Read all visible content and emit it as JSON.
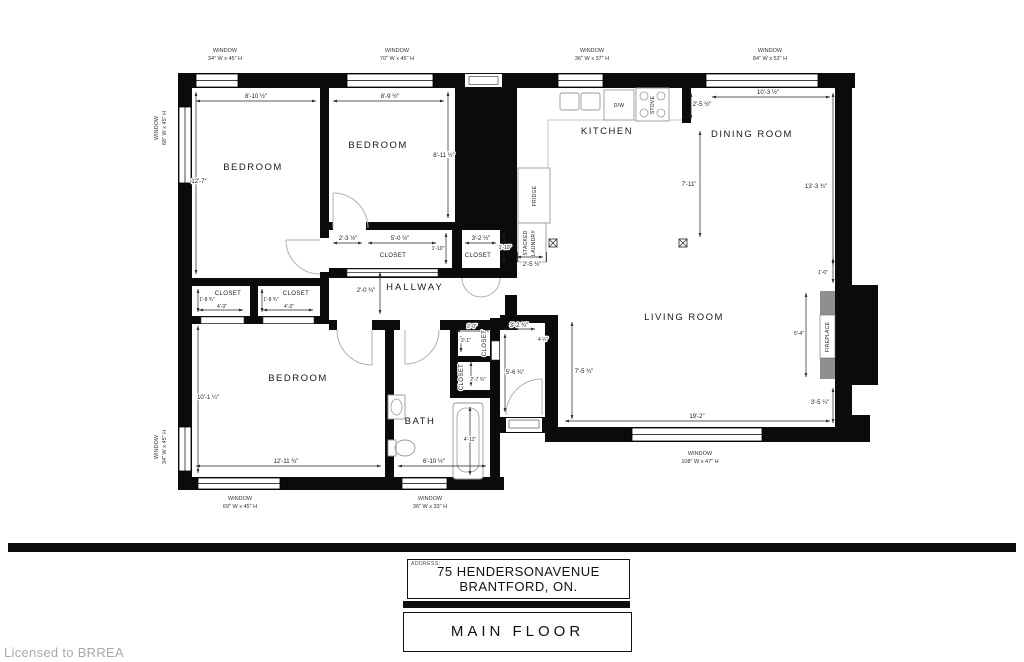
{
  "footer": {
    "address_label": "ADDRESS:",
    "address_line1": "75 HENDERSONAVENUE",
    "address_line2": "BRANTFORD, ON.",
    "floor_title": "MAIN FLOOR",
    "license": "Licensed to BRREA"
  },
  "rooms": {
    "bedroom1": "BEDROOM",
    "bedroom2": "BEDROOM",
    "bedroom3": "BEDROOM",
    "kitchen": "KITCHEN",
    "dining": "DINING ROOM",
    "living": "LIVING ROOM",
    "hallway": "HALLWAY",
    "bath": "BATH",
    "closet_mid": "CLOSET",
    "closet_right": "CLOSET",
    "closet_a": "CLOSET",
    "closet_b": "CLOSET",
    "closet_col_upper": "CLOSET",
    "closet_col_lower": "CLOSET"
  },
  "fixtures": {
    "dishwasher": "D/W",
    "stove": "STOVE",
    "fridge": "FRIDGE",
    "laundry1": "STACKED",
    "laundry2": "LAUNDRY",
    "fireplace": "FIREPLACE"
  },
  "windows": {
    "label": "WINDOW",
    "top1": "34\" W x 45\" H",
    "top2": "70\" W x 45\" H",
    "top3": "36\" W x 37\" H",
    "top4": "84\" W x 53\" H",
    "left1": "68\" W x 45\" H",
    "left2": "34\" W x 45\" H",
    "bottom1": "69\" W x 45\" H",
    "bottom2": "36\" W x 33\" H",
    "bottom3": "108\" W x 47\" H"
  },
  "dims": {
    "bed1_w": "8'-10 ½\"",
    "bed1_h": "12'-7\"",
    "bed2_w": "8'-9 ½\"",
    "bed2_h": "8'-11 ½\"",
    "bed2_door": "2'-3 ½\"",
    "closet_mid_w": "5'-0 ½\"",
    "closet_mid_d": "1'-10\"",
    "closet_r_w": "3'-2 ½\"",
    "closet_r_d": "1'-10\"",
    "kitchen_pass": "2'-5 ¾\"",
    "hall_w": "2'-0 ¾\"",
    "closet_a_d": "1'-8 ¾\"",
    "closet_a_w": "4'-3\"",
    "closet_b_d": "1'-8 ¾\"",
    "closet_b_w": "4'-3\"",
    "bed3_h": "10'-1 ¼\"",
    "bed3_w": "12'-11 ¾\"",
    "bath_tub": "4'-11\"",
    "bath_w": "6'-10 ½\"",
    "cc_w": "2'-0\"",
    "cc_h": "2'-1\"",
    "cc_d": "2'-7 ¾\"",
    "vest_w": "3'-2 ¾\"",
    "vest_jog": "4 ¼\"",
    "vest_h": "5'-6 ¾\"",
    "lr_h": "7'-5 ¾\"",
    "lr_w": "19'-2\"",
    "lr_corner": "3'-5 ¼\"",
    "fp_h": "5'-4\"",
    "fp_off": "1'-0\"",
    "kit_stub": "2'-5 ½\"",
    "din_w": "10'-3 ½\"",
    "din_h": "7'-11\"",
    "din_r": "13'-3 ¾\""
  },
  "colors": {
    "wall": "#0b0b0b",
    "fireplace_gray": "#8f8f8f",
    "license_gray": "#a9a9a9"
  }
}
